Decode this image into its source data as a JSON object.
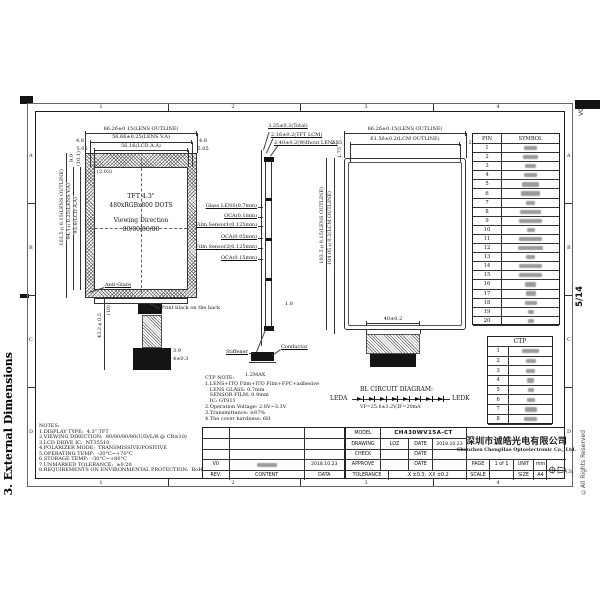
{
  "sheet": {
    "section_title": "3. External Dimensions",
    "version": "V0",
    "page_num": "5/14",
    "copyright": "©All Rights Reserved",
    "zone_cols": [
      "1",
      "2",
      "3",
      "4"
    ],
    "zone_rows": [
      "A",
      "B",
      "C",
      "D"
    ]
  },
  "front": {
    "title_lines": [
      "TFT 4.3\"",
      "480xRGBx800 DOTS",
      "Viewing Direction",
      "80/80/80/80"
    ],
    "dim_outline_w": "66.26±0.15(LENS OUTLINE)",
    "dim_va_w": "56.66±0.25(LENS V.A)",
    "dim_aa_w": "56.16(LCD A.A)",
    "dim_side_l1": "4.8",
    "dim_side_r1": "4.8",
    "dim_side_l2": "5.05",
    "dim_side_r2": "5.05",
    "dim_outline_h": "103.5±0.15(LENS OUTLINE)",
    "dim_va_h": "94.1±0.25(LENS V.A)",
    "dim_aa_h": "93.6(LCD A.A)",
    "dim_top_small_1": "9.9",
    "dim_top_small_2": "(10.1)",
    "dim_corner": "(2.03)",
    "anti_glare": "Anti-Glare",
    "print_note": "Print black on the back",
    "dim_fpc_h": "43.2±0.5",
    "dim_fpc_1": "(10)",
    "dim_fpc_2": "3.9",
    "dim_fpc_3": "4±0.3"
  },
  "stack": {
    "dim_total": "3.35±0.2(Total)",
    "dim_lcm": "2.16±0.2(TFT LCM)",
    "dim_wo_lens": "2.40±0.2(Without LENS)",
    "layers": [
      "Glass LENS(0.7mm)",
      "OCA(0.1mm)",
      "Film Sensor1(0.125mm)",
      "OCA(0.05mm)",
      "Film Sensor2(0.125mm)",
      "OCA(0.15mm)"
    ],
    "stiffener": "Stiffener",
    "conductor": "Conductor",
    "dim_fpc": "1.2MAX",
    "dim_small": "1.8"
  },
  "back": {
    "dim_outline_w": "66.26±0.15(LENS OUTLINE)",
    "dim_lcm_w": "61.56±0.2(LCM OUTLINE)",
    "dim_side_l": "2.35",
    "dim_side_r": "2.35",
    "dim_top_small": "1.75",
    "dim_outline_h": "103.5±0.15(LENS OUTLINE)",
    "dim_lcm_h": "104.05±0.2(LCM OUTLINE)",
    "dim_fpc_w": "40±0.2"
  },
  "pin_table": {
    "col_pin": "PIN",
    "col_symbol": "SYMBOL",
    "symbols_illegible": true,
    "rows": [
      {
        "pin": "1",
        "w": 13
      },
      {
        "pin": "2",
        "w": 15
      },
      {
        "pin": "3",
        "w": 11
      },
      {
        "pin": "4",
        "w": 13
      },
      {
        "pin": "5",
        "w": 17
      },
      {
        "pin": "6",
        "w": 19
      },
      {
        "pin": "7",
        "w": 9
      },
      {
        "pin": "8",
        "w": 21
      },
      {
        "pin": "9",
        "w": 23
      },
      {
        "pin": "10",
        "w": 8
      },
      {
        "pin": "11",
        "w": 23
      },
      {
        "pin": "12",
        "w": 25
      },
      {
        "pin": "13",
        "w": 9
      },
      {
        "pin": "14",
        "w": 23
      },
      {
        "pin": "15",
        "w": 23
      },
      {
        "pin": "16",
        "w": 11
      },
      {
        "pin": "17",
        "w": 10
      },
      {
        "pin": "18",
        "w": 12
      },
      {
        "pin": "19",
        "w": 6
      },
      {
        "pin": "20",
        "w": 6
      }
    ]
  },
  "ctp_table": {
    "title": "CTP",
    "symbols_illegible": true,
    "rows": [
      {
        "pin": "1",
        "w": 17
      },
      {
        "pin": "2",
        "w": 10
      },
      {
        "pin": "3",
        "w": 9
      },
      {
        "pin": "4",
        "w": 7
      },
      {
        "pin": "5",
        "w": 6
      },
      {
        "pin": "6",
        "w": 8
      },
      {
        "pin": "7",
        "w": 12
      },
      {
        "pin": "8",
        "w": 13
      }
    ]
  },
  "bl": {
    "title": "BL CIRCUIT DIAGRAM:",
    "anode": "LEDA",
    "cathode": "LEDK",
    "spec": "VF=25.6±3.2V,IF=20mA",
    "led_count": 8
  },
  "ctp_note": {
    "lines": [
      "CTP NOTE:",
      "1.LENS+ITO Film+ITO Film+FPC+adhesive",
      "   LENS GLASS: 0.7mm",
      "   SENSOR FILM: 0.9mm",
      "   IC: GT911",
      "2.Operation Voltage: 2.8V~3.3V",
      "3.Transmittance: ≥87%",
      "4.The cover hardness: 6H"
    ]
  },
  "notes": {
    "lines": [
      "NOTES:",
      "1.DISPLAY TYPE:  4.3\" TFT",
      "2.VIEWING DIRECTION:  80/80/80/80(U/D/L/R @ CR≥10)",
      "3.LCD DRIVE IC:  NT35510",
      "4.POLARIZER MODE:  TRANSMISSIVE/POSITIVE",
      "5.OPERATING TEMP:  -20°C~+70°C",
      "6.STORAGE TEMP:  -30°C~+80°C",
      "7.UNMARKED TOLERANCE:  ±0.20",
      "8.REQUIREMENTS ON ENVIRONMENTAL PROTECTION:  RoHS"
    ]
  },
  "tb": {
    "model_label": "MODEL",
    "model_value": "CH430WV15A-CT",
    "drawing_label": "DRAWING",
    "drawing_value": "LOZ",
    "date_label": "DATE",
    "drawing_date": "2018.10.23",
    "check_label": "CHECK",
    "approve_label": "APPROVE",
    "tolerance_label": "TOLERANCE",
    "tolerance_value": ".X ±0.3, .XX ±0.2",
    "company_cn": "深圳市诚皓光电有限公司",
    "company_en": "Shenzhen ChengHao Optoelectronic Co., Ltd.",
    "page_label": "PAGE",
    "page_value": "1 of 1",
    "unit_label": "UNIT",
    "unit_value": "mm",
    "scale_label": "SCALE",
    "scale_value": "",
    "size_label": "SIZE",
    "size_value": "A4",
    "projection_note": "(3)"
  },
  "rev": {
    "rev_label": "REV.",
    "content_label": "CONTENT",
    "data_label": "DATA",
    "row_rev": "V0",
    "row_date": "2018.10.23",
    "row_content_illegible": true
  }
}
